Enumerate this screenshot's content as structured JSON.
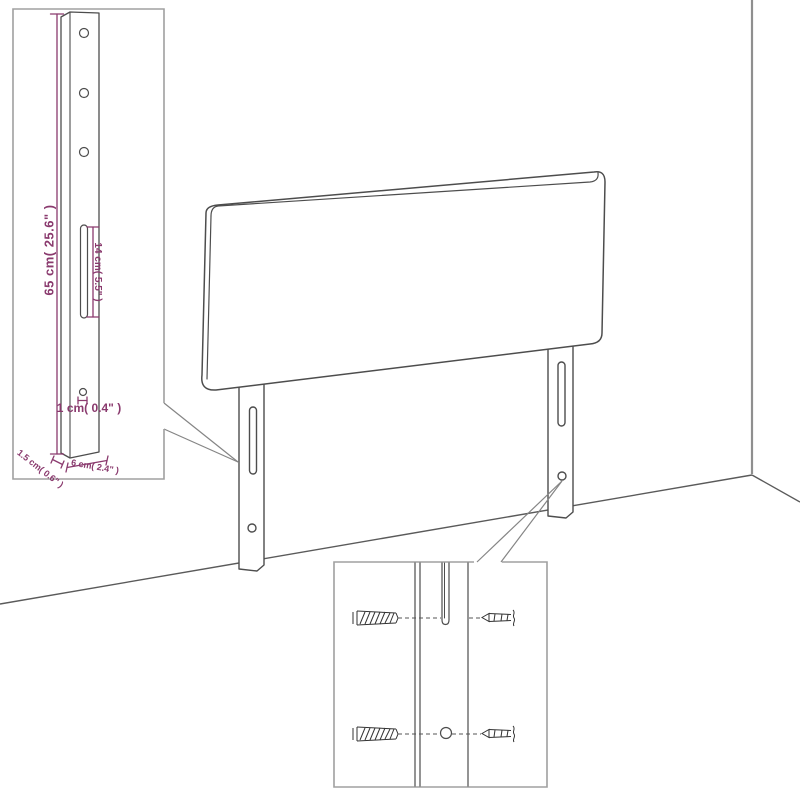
{
  "diagram": {
    "type": "furniture-assembly-dimension-diagram",
    "subject": "upholstered headboard with two slotted mounting legs",
    "insets": [
      {
        "name": "leg-detail",
        "shows": "full leg with holes, slot and dimensions"
      },
      {
        "name": "screw-detail",
        "shows": "screws aligning with leg slot and hole"
      }
    ]
  },
  "dimensions": {
    "leg_height": "65 cm( 25.6\" )",
    "slot_length": "14 cm( 5.5\" )",
    "hole_diameter": "1 cm( 0.4\" )",
    "leg_thickness": "1.5 cm( 0.6\" )",
    "leg_width": "6 cm( 2.4\" )"
  },
  "colors": {
    "dimension_accent": "#8a3a6e",
    "line": "#4d4d4d",
    "inset_border": "#a0a0a0",
    "background": "#ffffff"
  }
}
